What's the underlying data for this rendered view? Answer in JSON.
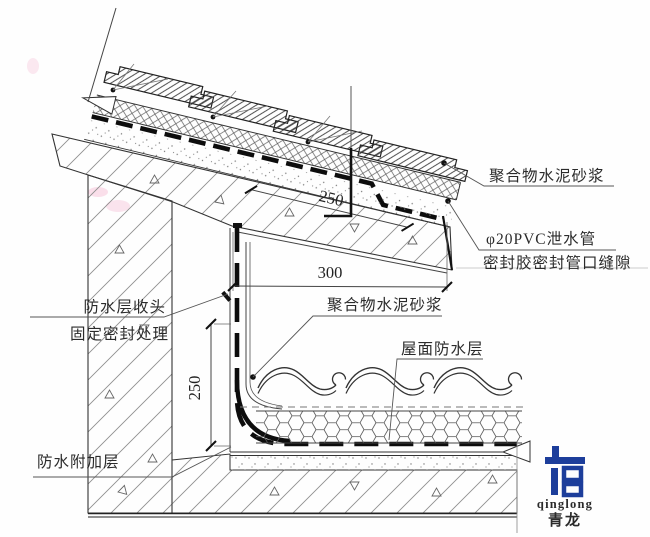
{
  "drawing": {
    "labels": {
      "mortar_top": "聚合物水泥砂浆",
      "drain_pipe": "φ20PVC泄水管",
      "seal_gap": "密封胶密封管口缝隙",
      "wp_head_1": "防水层收头",
      "wp_head_2": "固定密封处理",
      "mortar_mid": "聚合物水泥砂浆",
      "roof_wp": "屋面防水层",
      "wp_add": "防水附加层"
    },
    "dimensions": {
      "slope_offset": "250",
      "eave_width": "300",
      "wall_height": "250"
    },
    "logo": {
      "latin": "qinglong",
      "cjk": "青龙",
      "color": "#1d3e9b"
    },
    "colors": {
      "line": "#2a2a2a",
      "hatch": "#8a8a8a",
      "waterproof": "#0d0d0d"
    }
  }
}
